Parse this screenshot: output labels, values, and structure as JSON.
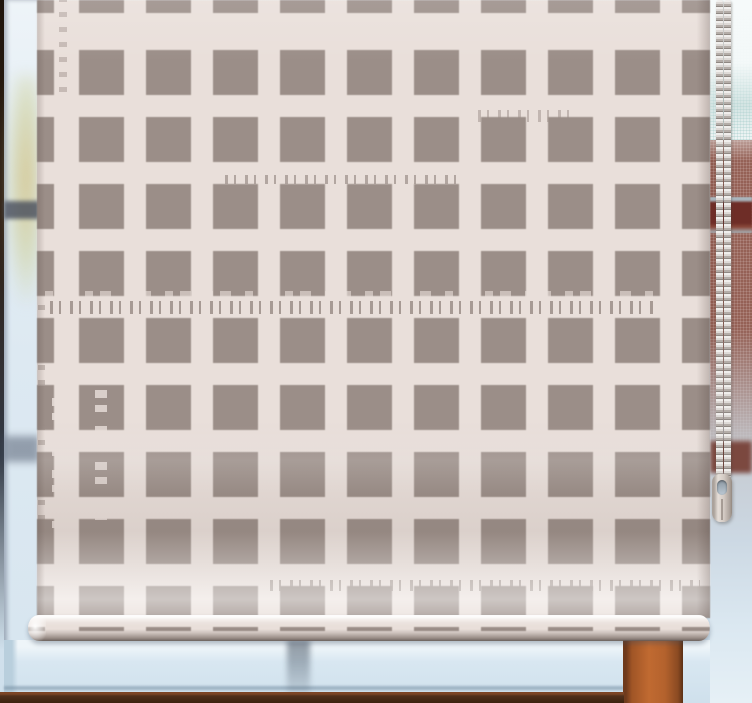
{
  "scene": {
    "subject": "Cream roller blind with a distressed taupe check / lattice square pattern hanging in a window",
    "elements": [
      "roller-blind",
      "check-pattern",
      "blind-bottom-bar",
      "beaded-pull-chain",
      "chain-connector",
      "frosted-window-glass",
      "window-mullion",
      "window-sill",
      "brick-wall-outside"
    ]
  },
  "colors": {
    "blind-square": "#9b8e88",
    "blind-lattice": "#e9dfda",
    "glass-light": "#d3e3ee",
    "glass-white": "#eef5f8",
    "glass-edge": "#b9cfdd",
    "frame-dark": "#2f1f15",
    "sill-brown": "#50301c",
    "sill-edge": "#7c4526",
    "mullion-orange": "#b4622d",
    "mullion-dark": "#6f3a1c",
    "brick": "#9a665b",
    "red-band": "#6e2d27",
    "chain-bead": "#dedad7",
    "chain-dark": "#8f8883",
    "connector-body": "#d3cac3",
    "foliage-warm": "#d6c896",
    "smudge-dark": "#3c4254"
  }
}
